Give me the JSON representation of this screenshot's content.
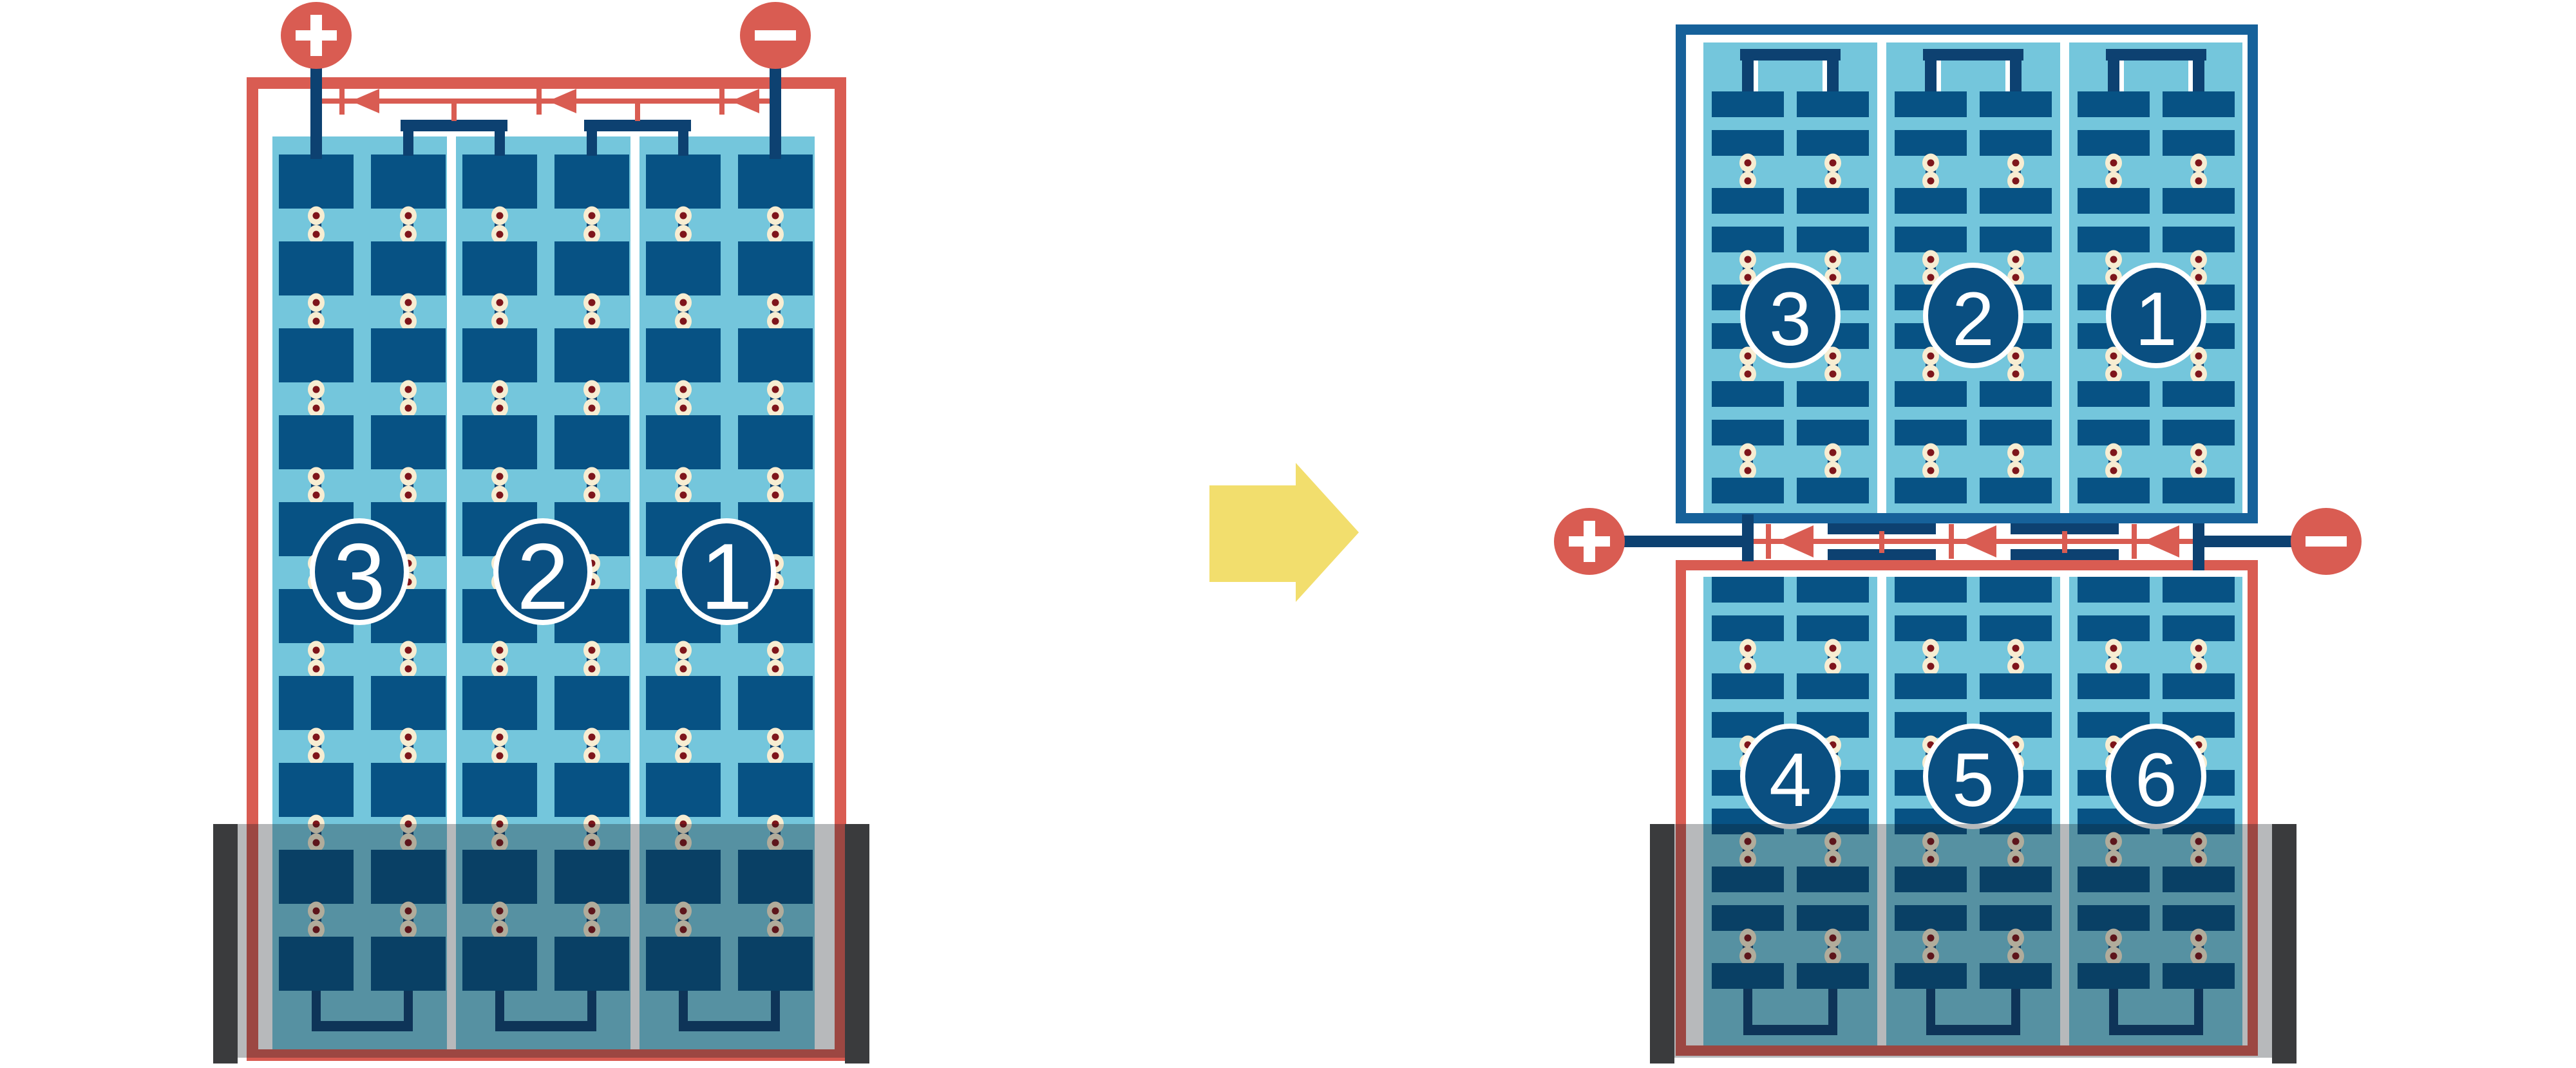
{
  "palette": {
    "red": "#D95C52",
    "frame_blue": "#16619A",
    "plate_blue": "#075284",
    "navy": "#0D4171",
    "badge_blue": "#0A4F81",
    "light_blue": "#74C6DC",
    "rivet_ring": "#F7EDD2",
    "rivet_core": "#7E151B",
    "arrow_yellow": "#F2DE6D",
    "tank_overlay": "rgba(15,22,30,0.30)",
    "tank_wall": "#3A3B3D",
    "background": "#FFFFFF",
    "label_text": "#FFFFFF",
    "terminal_glyph": "#FFFFFF"
  },
  "before_panel": {
    "name": "single-stack-before",
    "terminal_positive": "+",
    "terminal_negative": "−",
    "cell_labels": [
      "3",
      "2",
      "1"
    ]
  },
  "after_top_panel": {
    "name": "upper-stack-after",
    "cell_labels": [
      "3",
      "2",
      "1"
    ]
  },
  "after_bottom_panel": {
    "name": "lower-stack-after",
    "terminal_positive": "+",
    "terminal_negative": "−",
    "cell_labels": [
      "4",
      "5",
      "6"
    ]
  },
  "transform_arrow": {
    "direction": "right"
  }
}
